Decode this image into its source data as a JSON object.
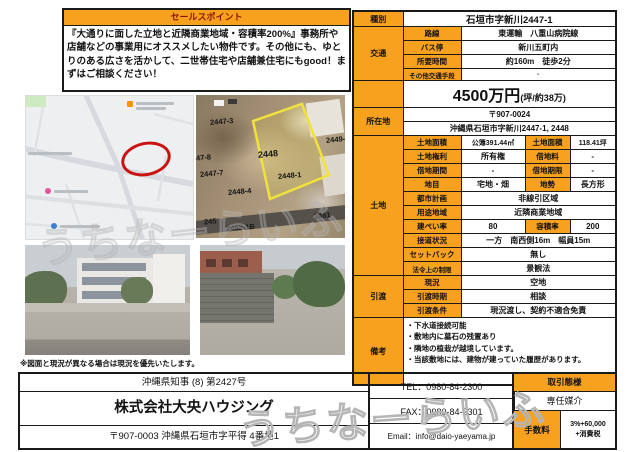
{
  "colors": {
    "accent_orange": "#F7A11E",
    "sales_header_text": "#8B1500",
    "map_marker_red": "#CC1111",
    "parcel_outline_yellow": "#F0E13C"
  },
  "sales": {
    "header": "セールスポイント",
    "body": "『大通りに面した立地と近隣商業地域・容積率200%』事務所や店舗などの事業用にオススメしたい物件です。その他にも、ゆとりのある広さを活かして、二世帯住宅や店舗兼住宅にもgood！まずはご相談ください！"
  },
  "table": {
    "type_label": "種別",
    "type_value": "石垣市字新川2447-1",
    "access_label": "交通",
    "access_rows": [
      {
        "l": "路線",
        "v": "東運輸　八重山病院線"
      },
      {
        "l": "バス停",
        "v": "新川五町内"
      },
      {
        "l": "所要時間",
        "v": "約160m　徒歩2分"
      },
      {
        "l": "その他交通手段",
        "v": "-"
      }
    ],
    "price": "4500万円",
    "price_note": "(坪/約38万)",
    "location_label": "所在地",
    "postal": "〒907-0024",
    "address": "沖縄県石垣市字新川2447-1, 2448",
    "land_label": "土地",
    "land_rows": [
      {
        "l1": "土地面積",
        "v1": "公簿391.44㎡",
        "l2": "土地面積",
        "v2": "118.41坪"
      },
      {
        "l1": "土地権利",
        "v1": "所有権",
        "l2": "借地料",
        "v2": "-"
      },
      {
        "l1": "借地期間",
        "v1": "-",
        "l2": "借地期限",
        "v2": "-"
      },
      {
        "l1": "地目",
        "v1": "宅地・畑",
        "l2": "地勢",
        "v2": "長方形"
      },
      {
        "l1": "都市計画",
        "v1": "非線引区域"
      },
      {
        "l1": "用途地域",
        "v1": "近隣商業地域"
      },
      {
        "l1": "建ぺい率",
        "v1": "80",
        "l2": "容積率",
        "v2": "200"
      },
      {
        "l1": "接道状況",
        "v1": "一方　南西側16m　幅員15m"
      },
      {
        "l1": "セットバック",
        "v1": "無し"
      },
      {
        "l1": "法令上の制限",
        "v1": "景観法"
      }
    ],
    "handover_label": "引渡",
    "handover_rows": [
      {
        "l": "現況",
        "v": "空地"
      },
      {
        "l": "引渡時期",
        "v": "相談"
      },
      {
        "l": "引渡条件",
        "v": "現況渡し、契約不適合免責"
      }
    ],
    "notes_label": "備考",
    "notes": [
      "・下水道接続可能",
      "・敷地内に墓石の残置あり",
      "・隣地の植栽が越境しています。",
      "・当該敷地には、建物が建っていた履歴があります。"
    ]
  },
  "aerial": {
    "parcels": [
      "2447-3",
      "47-8",
      "2447-7",
      "2448",
      "2448-1",
      "2448-4",
      "2449-",
      "245",
      "2452-1B",
      "2451"
    ]
  },
  "disclaimer": "※図面と現況が異なる場合は現況を優先いたします。",
  "footer": {
    "license": "沖縄県知事 (8) 第2427号",
    "company": "株式会社大央ハウジング",
    "company_address": "〒907-0003 沖縄県石垣市字平得 4番地1",
    "tel": "TEL：0980-84-2300",
    "fax": "FAX：0980-84-2301",
    "email": "Email：info@daio-yaeyama.jp",
    "deal_type_label": "取引態様",
    "deal_type_value": "専任媒介",
    "fee_label": "手数料",
    "fee_line1": "3%+60,000",
    "fee_line2": "+消費税"
  },
  "watermark": "うちなーらいふ"
}
